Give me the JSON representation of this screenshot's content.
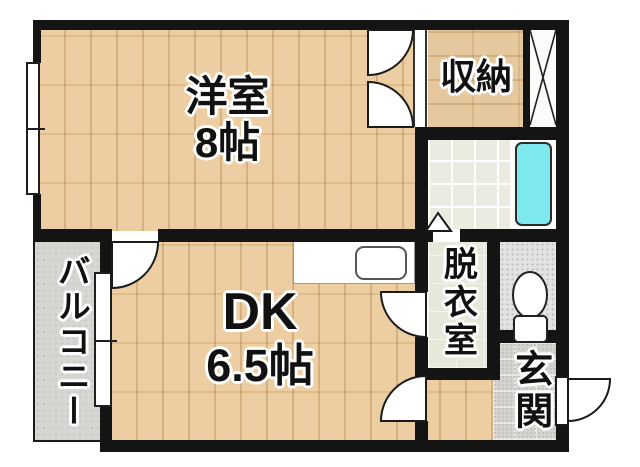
{
  "title": "apartment-floorplan",
  "rooms": {
    "western_room": {
      "name": "洋室",
      "size": "8帖"
    },
    "dk": {
      "name": "DK",
      "size": "6.5帖"
    },
    "closet": {
      "name": "収納"
    },
    "balcony": {
      "name": "バルコニー"
    },
    "dressing_room": {
      "name": "脱衣室"
    },
    "entrance": {
      "name": "玄関"
    }
  },
  "fixtures": {
    "bathtub": "bathtub-icon",
    "toilet": "toilet-icon",
    "kitchen_sink": "kitchen-sink-icon",
    "pipe_space": "pipe-space-x-icon",
    "bath_door": "bath-door-triangle-icon",
    "door_swings": "door-arc-icon",
    "windows": "sliding-window-icon"
  },
  "colors": {
    "wall": "#141414",
    "wood_floor": "#ebc997",
    "closet_floor": "#e3c294",
    "bath_tile": "#ecebe2",
    "bathtub": "#7de9ee",
    "dressing_floor": "#e6e9d9",
    "toilet_floor": "#e2e2e2",
    "entrance_floor": "#d4d3d0",
    "balcony_floor": "#d8d6d2"
  }
}
